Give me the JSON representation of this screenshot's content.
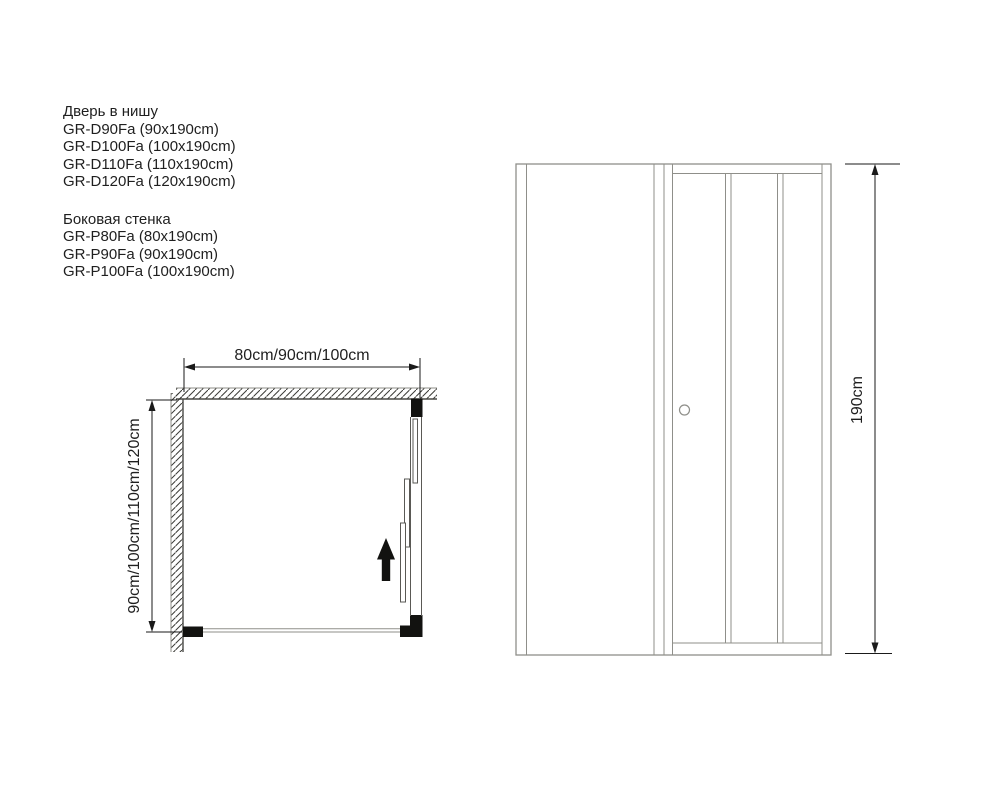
{
  "title_block": {
    "door": {
      "title": "Дверь в нишу",
      "items": [
        "GR-D90Fa (90x190cm)",
        "GR-D100Fa (100x190cm)",
        "GR-D110Fa (110x190cm)",
        "GR-D120Fa (120x190cm)"
      ]
    },
    "side": {
      "title": "Боковая стенка",
      "items": [
        "GR-P80Fa (80x190cm)",
        "GR-P90Fa (90x190cm)",
        "GR-P100Fa (100x190cm)"
      ]
    }
  },
  "plan_view": {
    "width_dimension": "80cm/90cm/100cm",
    "depth_dimension": "90cm/100cm/110cm/120cm"
  },
  "elevation_view": {
    "height_dimension": "190cm"
  },
  "colors": {
    "dimension_line": "#1a1a1a",
    "wall_line": "#4a4a46",
    "hatch_line": "#3a3a36",
    "profile_black": "#121210",
    "elevation_grey": "#8f8f8a",
    "text": "#1f1f1f"
  }
}
